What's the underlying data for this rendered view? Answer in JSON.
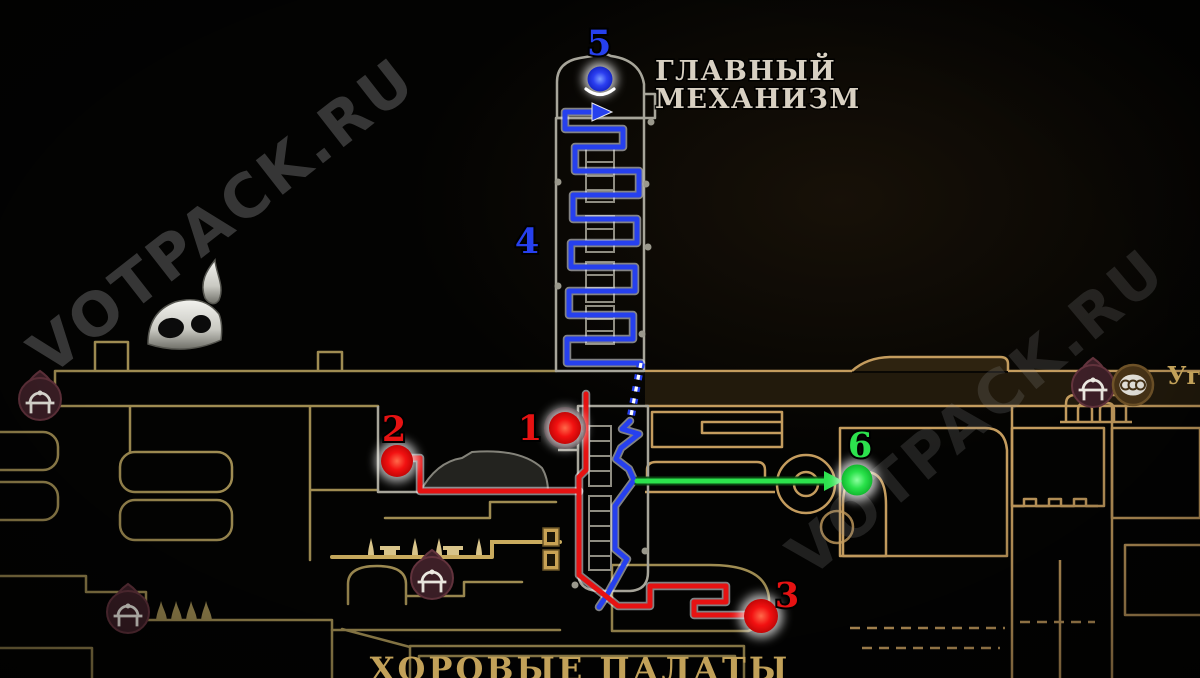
{
  "game_map": {
    "title_labels": {
      "main_mechanism_line1": "ГЛАВНЫЙ",
      "main_mechanism_line2": "МЕХАНИЗМ",
      "choral_chambers": "ХОРОВЫЕ ПАЛАТЫ",
      "right_edge_partial": "Уго"
    },
    "watermark": {
      "text": "VOTPACK.RU"
    },
    "markers": [
      {
        "label": "1",
        "color": "red",
        "shape": "dot"
      },
      {
        "label": "2",
        "color": "red",
        "shape": "dot"
      },
      {
        "label": "3",
        "color": "red",
        "shape": "dot"
      },
      {
        "label": "4",
        "color": "blue",
        "shape": "label-only"
      },
      {
        "label": "5",
        "color": "blue",
        "shape": "dot"
      },
      {
        "label": "6",
        "color": "green",
        "shape": "dot"
      }
    ],
    "routes": {
      "blue_spire": {
        "points": "641,363 567,363 567,339 633,339 633,315 569,315 569,291 635,291 635,267 571,267 571,243 637,243 637,219 573,219 573,195 639,195 639,171 575,171 575,147 623,147 623,129 565,129 565,112 592,112"
      },
      "blue_arrow": {
        "points": "592,103 612,112 592,121"
      },
      "blue_dotted": {
        "points": "641,363 630,421"
      },
      "blue_descent": {
        "points": "630,421 622,429 639,434 621,448 616,459 629,469 634,480 615,506 615,549 627,559 607,595 599,607"
      },
      "red_marker1_stub": {
        "points": "568,428 586,428"
      },
      "red_marker1_vertical": {
        "points": "586,394 586,470 579,477 579,492"
      },
      "red_marker2": {
        "points": "404,458 420,458 420,491 579,491"
      },
      "red_to_marker3": {
        "points": "579,491 579,575 607,597 618,606 650,606 650,586 726,586 726,602 694,602 694,615 748,615"
      },
      "green_line": {
        "points": "637,481 826,481"
      },
      "green_arrow": {
        "points": "824,471 843,481 824,491"
      }
    },
    "icons": [
      {
        "name": "bench-icon",
        "x": 40,
        "y": 399
      },
      {
        "name": "bench-icon",
        "x": 128,
        "y": 612
      },
      {
        "name": "bench-icon",
        "x": 432,
        "y": 578
      },
      {
        "name": "bench-icon",
        "x": 1093,
        "y": 386
      },
      {
        "name": "tube-station-icon",
        "x": 1133,
        "y": 385
      },
      {
        "name": "bell-station-icon",
        "x": 185,
        "y": 322
      }
    ],
    "colors": {
      "route_blue": "#2640ee",
      "route_red": "#e61212",
      "route_green": "#2ce24d",
      "map_outline": "#9f8c52",
      "map_outline_bright": "#c9ab5e",
      "right_outline": "#c49c5e",
      "brown_room_fill": "#473827",
      "tower_outline": "#a7a59a",
      "bench_circle": "#3d1f27",
      "main_title_text": "#d8d0c2",
      "gold_text": "#c2a159",
      "watermark_grey": "#8f8f8f"
    }
  }
}
